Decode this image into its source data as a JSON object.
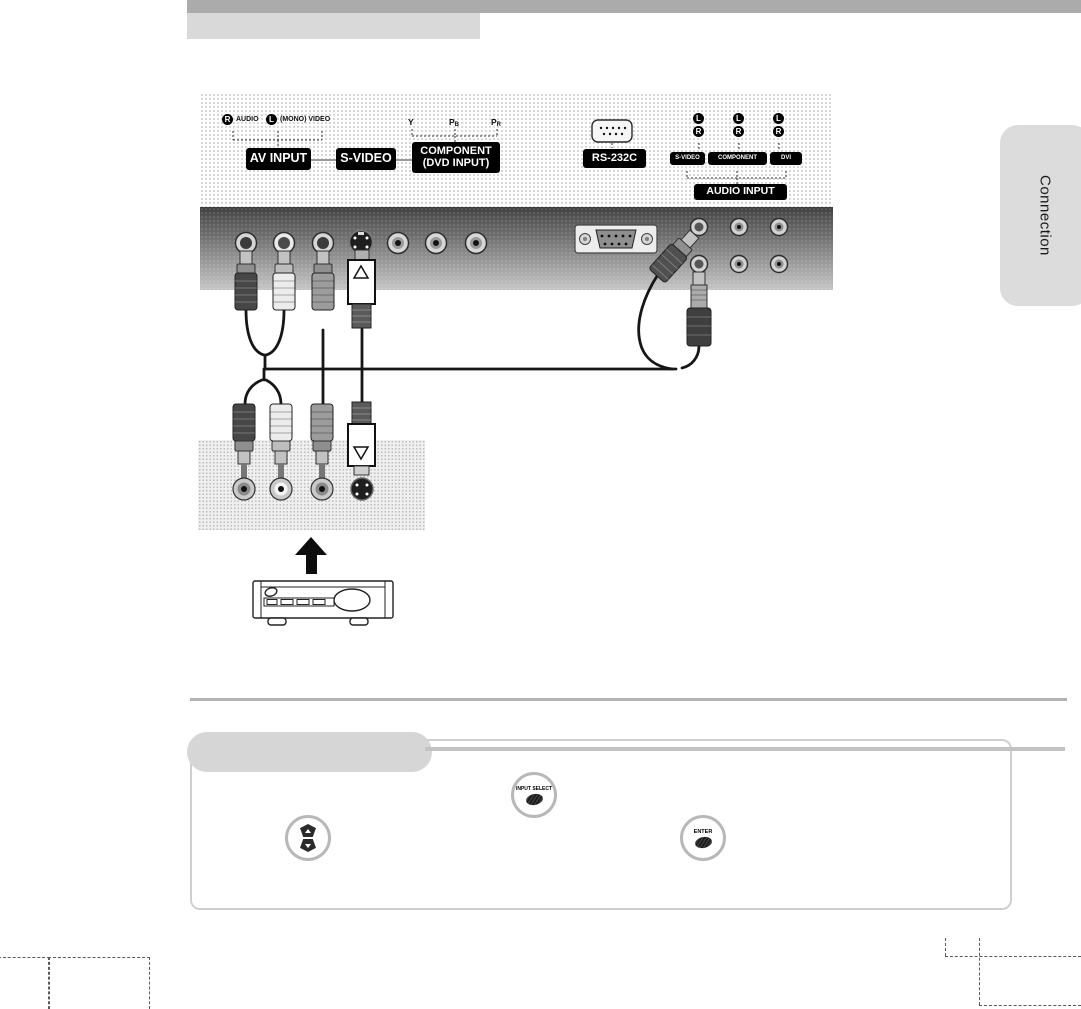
{
  "page": {
    "tab_label": "Connection"
  },
  "colors": {
    "top_bar": "#ababab",
    "header_box": "#d9d9d9",
    "tab_bg": "#dcdcdc",
    "label_bg": "#000000",
    "label_fg": "#ffffff",
    "panel_gradient_top": "#3c3c3c",
    "panel_gradient_bottom": "#c6c6c6",
    "pill": "#d6d6d6"
  },
  "rear_panel": {
    "av_group": {
      "r_badge": "R",
      "r_text": "AUDIO",
      "l_badge": "L",
      "l_text": "(MONO) VIDEO",
      "av_input": "AV INPUT",
      "s_video": "S-VIDEO",
      "component_line1": "COMPONENT",
      "component_line2": "(DVD INPUT)",
      "y": "Y",
      "pb_base": "P",
      "pb_sub": "B",
      "pr_base": "P",
      "pr_sub": "R"
    },
    "rs232c": {
      "label": "RS-232C"
    },
    "audio_group": {
      "pairs": [
        {
          "l": "L",
          "r": "R"
        },
        {
          "l": "L",
          "r": "R"
        },
        {
          "l": "L",
          "r": "R"
        }
      ],
      "s_video": "S-VIDEO",
      "component": "COMPONENT",
      "dvi": "DVI",
      "audio_input": "AUDIO INPUT"
    }
  },
  "controls": {
    "input_select": "INPUT SELECT",
    "enter": "ENTER"
  }
}
